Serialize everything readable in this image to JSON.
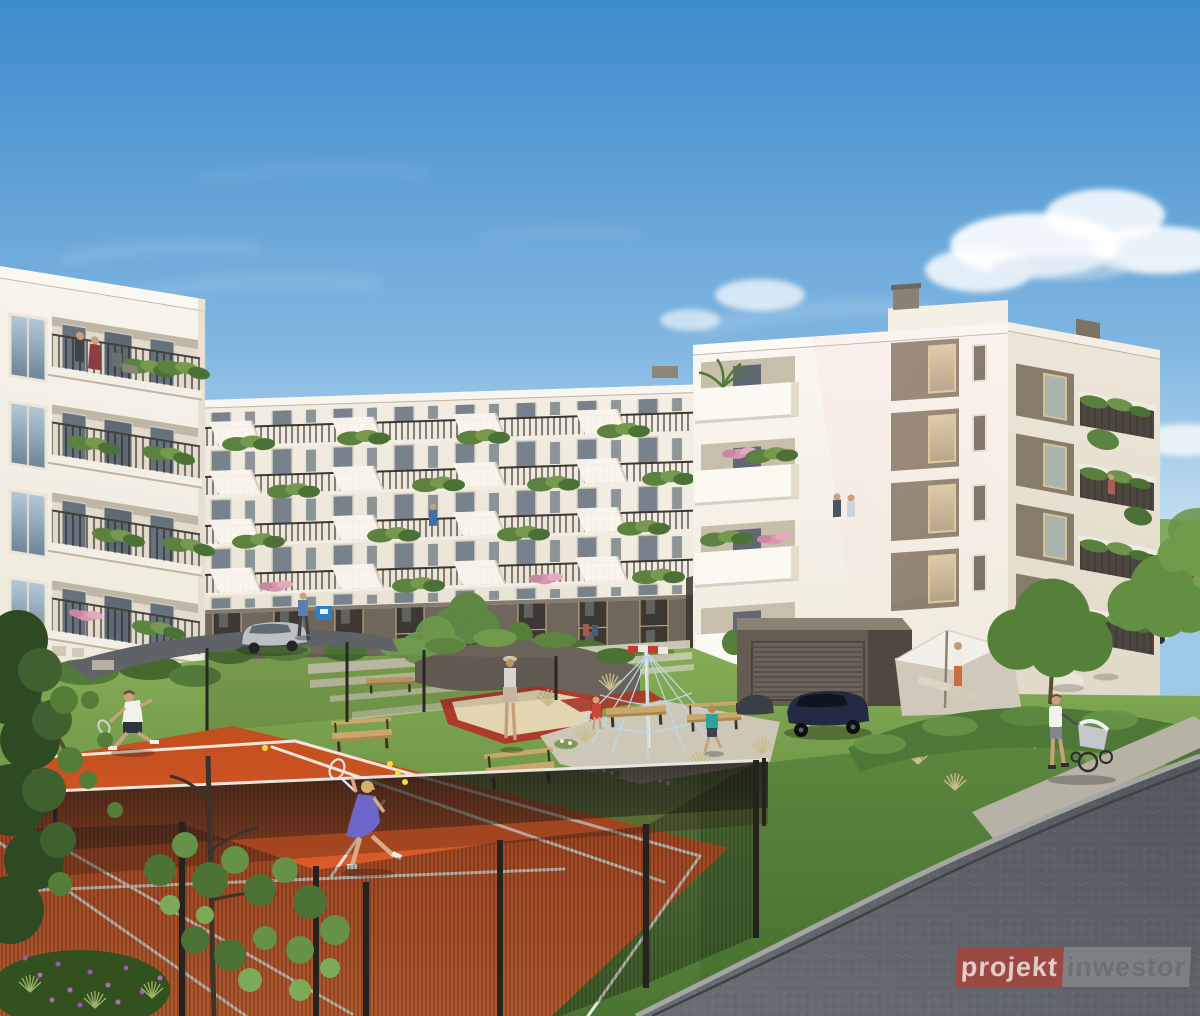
{
  "image": {
    "kind": "architectural exterior rendering",
    "description": "Residential apartment complex courtyard with clay tennis court, playground, lawns, parked cars and residents",
    "width_px": 1200,
    "height_px": 1016
  },
  "watermark": {
    "part1": "projekt",
    "part2": "inwestor"
  },
  "palette": {
    "sky_top": "#3d8bcb",
    "sky_horizon": "#ddeef8",
    "cloud_white": "#ffffff",
    "facade_white": "#f6f2e9",
    "facade_shadow": "#e6dfd0",
    "ground_floor_taupe": "#6f675b",
    "railing_dark": "#3f3a35",
    "plant_green": "#5d8240",
    "lawn_green": "#6c9a44",
    "court_clay": "#d95f2b",
    "court_line": "#f4f1ea",
    "net_dark": "#1e1a16",
    "fence_dark": "#26231f",
    "road_asphalt": "#5e6268",
    "curb_gray": "#a7aaa6",
    "sand_beige": "#e3d5b2",
    "playground_red": "#ae3a2c",
    "dress_violet": "#6f66c9",
    "car_silver": "#c0c3c6",
    "car_navy": "#242a42",
    "car_white": "#eceff0",
    "car_red": "#b03228",
    "umbrella_white": "#f4f1ea"
  },
  "scene": {
    "elements": [
      "apartment buildings with plant-covered balconies",
      "clay tennis court with two players",
      "black mesh court fence",
      "rope climbing pyramid playground",
      "sandbox with red border",
      "wooden benches",
      "garage with roller door",
      "patio with umbrella and loungers",
      "man pushing stroller on sidewalk",
      "parked cars",
      "curving asphalt road",
      "foreground foliage"
    ]
  }
}
